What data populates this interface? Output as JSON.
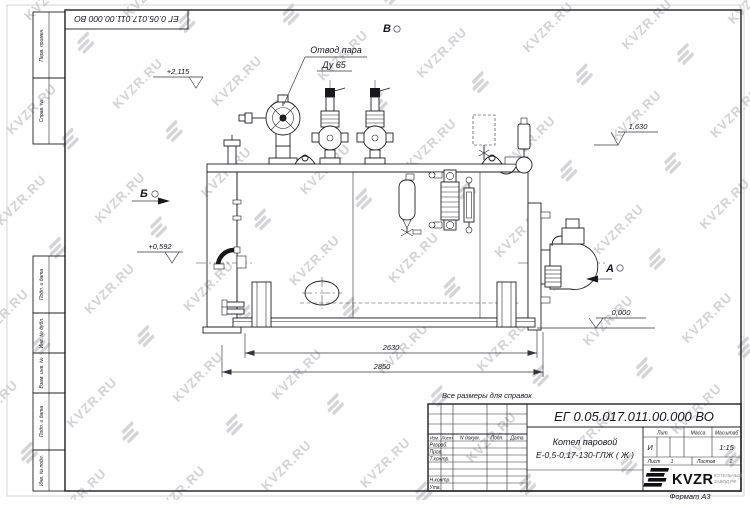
{
  "watermark": {
    "text": "KVZR.RU"
  },
  "corner_stamp": {
    "doc_number": "ЕГ 0.05.017.011.00.000 ВО"
  },
  "frame_labels": [
    "Перв. примен.",
    "Справ. №",
    "Подп. и дата",
    "Инв. № дубл.",
    "Взам. инв. №",
    "Подп. и дата",
    "Инв. № подл."
  ],
  "note": "Все размеры для справок",
  "drawing": {
    "callout_steam_line1": "Отвод пара",
    "callout_steam_line2": "Ду 65",
    "view_a": "А",
    "view_b": "Б",
    "view_v": "В",
    "elev_valves": "+2,115",
    "elev_right": "1,630",
    "elev_door": "+0,592",
    "elev_zero": "0,000",
    "dim_inner": "2630",
    "dim_overall": "2850"
  },
  "title_block": {
    "doc_number": "ЕГ 0.05.017.011.00.000  ВО",
    "product_line1": "Котел паровой",
    "product_line2": "Е-0,5-0,17-130-ГЛЖ ( Ж )",
    "col_izm": "Изм.",
    "col_list": "Лист",
    "col_doc": "N докум.",
    "col_sign": "Подп.",
    "col_date": "Дата",
    "row_developed": "Разраб.",
    "row_checked": "Пров.",
    "row_tcontrol": "Т.контр.",
    "row_ncontrol": "Н.контр.",
    "row_approved": "Утв.",
    "lit_label": "Лит.",
    "mass_label": "Масса",
    "scale_label": "Масштаб",
    "lit_value": "И",
    "scale_value": "1:15",
    "sheet_label": "Лист",
    "sheet_number": "1",
    "sheets_label": "Листов",
    "sheets_total": "2",
    "logo_text": "KVZR",
    "logo_caption_line1": "КОТЕЛЬНЫЙ",
    "logo_caption_line2": "ЗАВОД.РФ",
    "format_label": "Формат А3"
  }
}
